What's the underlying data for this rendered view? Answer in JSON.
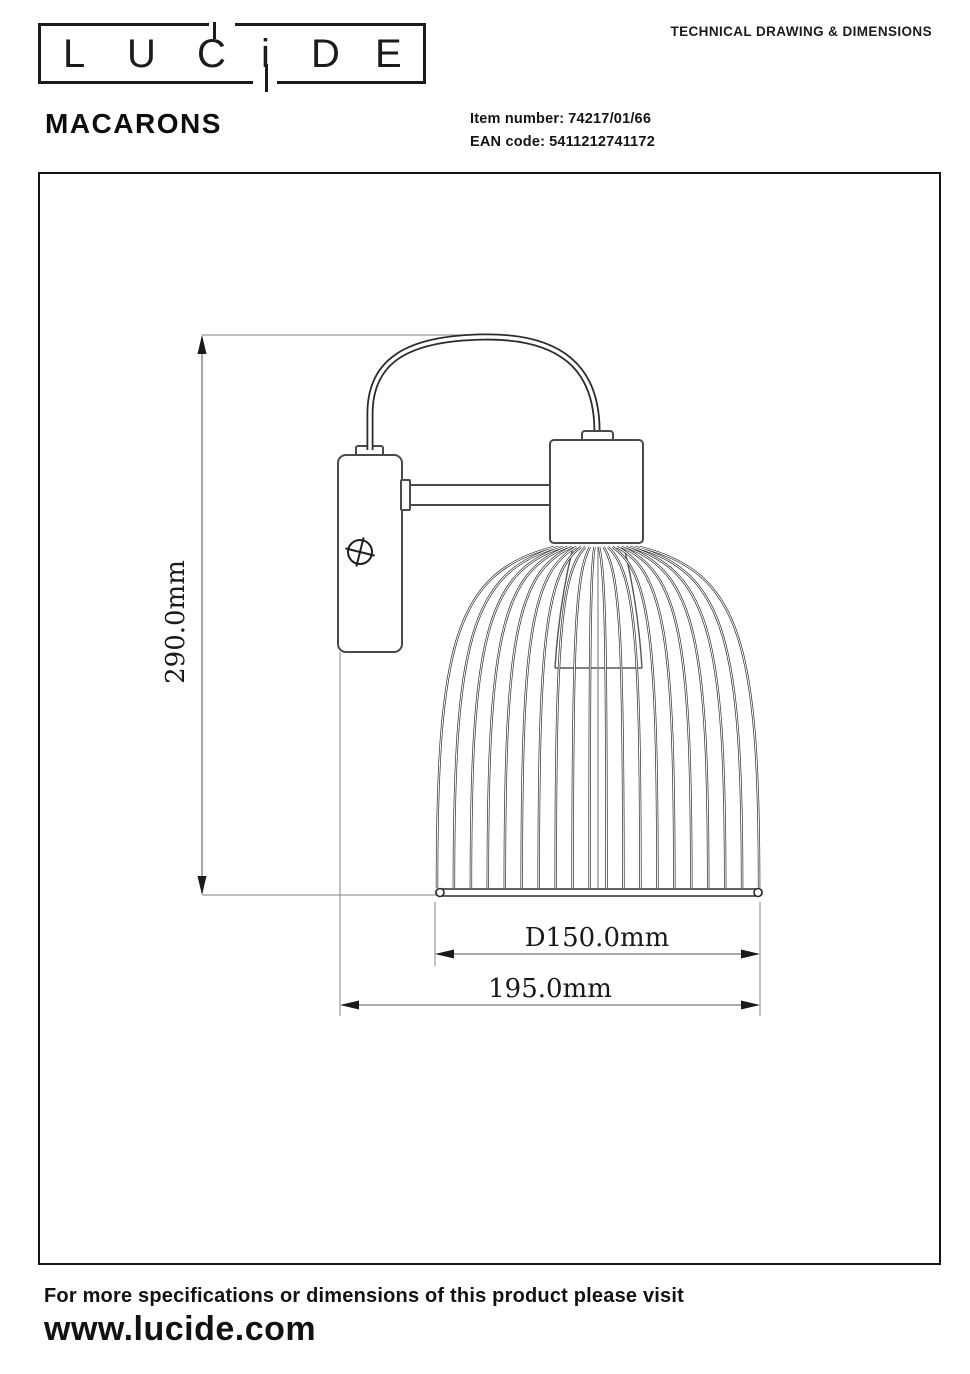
{
  "header": {
    "logo_letters": [
      "L",
      "U",
      "C",
      "i",
      "D",
      "E"
    ],
    "doc_title": "TECHNICAL DRAWING & DIMENSIONS",
    "product_name": "MACARONS",
    "item_number_label": "Item number:",
    "item_number": "74217/01/66",
    "ean_label": "EAN code:",
    "ean_code": "5411212741172"
  },
  "drawing": {
    "type": "wall-lamp technical drawing, side view",
    "dim_height": "290.0mm",
    "dim_diameter": "D150.0mm",
    "dim_projection": "195.0mm"
  },
  "footer": {
    "line1": "For more specifications or dimensions of this product please visit",
    "line2": "www.lucide.com"
  },
  "colors": {
    "ink": "#1a1a1a",
    "drawing_line": "#3c3c3c",
    "extension_line": "#909090",
    "background": "#ffffff"
  }
}
